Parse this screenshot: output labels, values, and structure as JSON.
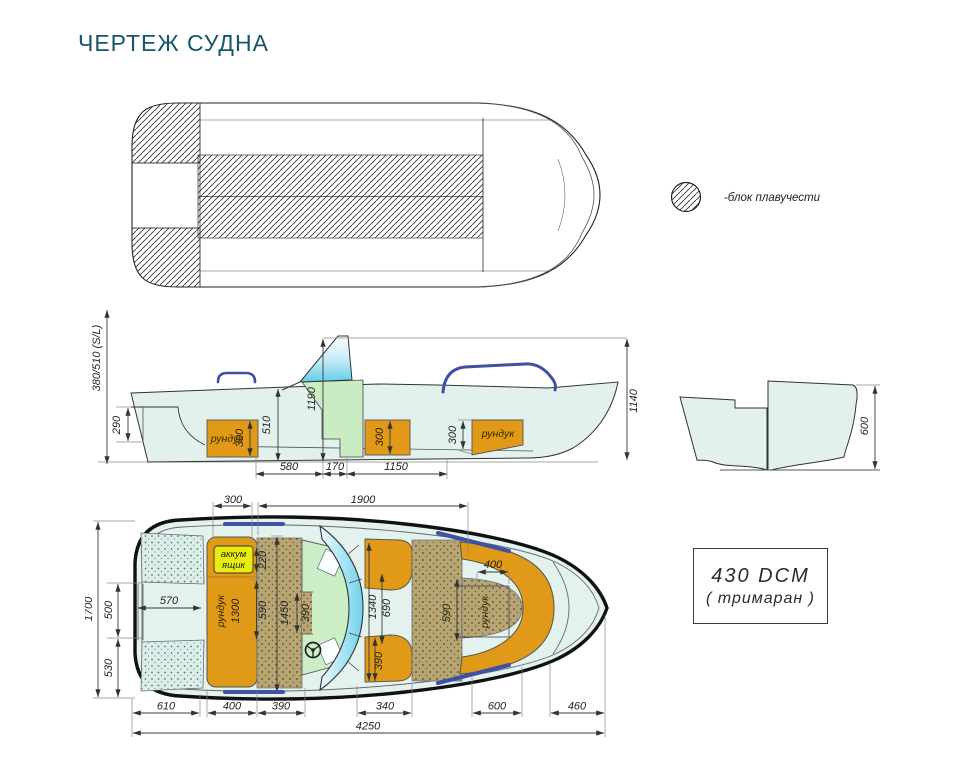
{
  "title": "ЧЕРТЕЖ СУДНА",
  "legend": {
    "label": "-блок плавучести"
  },
  "spec_box": {
    "model": "430 DCM",
    "type": "( тримаран )"
  },
  "colors": {
    "hull": "#e3f2ed",
    "seat_orange": "#e09a18",
    "battery_yellow": "#e8ec10",
    "floor_tan": "#b7a673",
    "console_green": "#cbeec6",
    "windshield_cyan": "#7fd8ee",
    "railing_blue": "#3f51a2",
    "title_teal": "#14566b"
  },
  "side_view": {
    "axis_label": "380/510 (S/L)",
    "locker_left": "рундук",
    "locker_right": "рундук",
    "d290": "290",
    "d510": "510",
    "d1190": "1190",
    "d1140": "1140",
    "d300_left": "300",
    "d300_mid": "300",
    "d300_right": "300",
    "d580": "580",
    "d170": "170",
    "d1150": "1150"
  },
  "transom_view": {
    "d600": "600"
  },
  "bottom_view": {
    "d1700": "1700",
    "d500": "500",
    "d530": "530",
    "d570": "570",
    "d300_top": "300",
    "d1900": "1900",
    "battery_line1": "аккум",
    "battery_line2": "ящик",
    "locker_main": "рундук",
    "d1300": "1300",
    "d220": "220",
    "d590_mid": "590",
    "d1450": "1450",
    "d390_console": "390",
    "d1340": "1340",
    "d690": "690",
    "d390_seat": "390",
    "d400_bow": "400",
    "d590_bow": "590",
    "locker_bow": "рундук",
    "d610": "610",
    "d400_bottom": "400",
    "d390_bottom": "390",
    "d340": "340",
    "d600_bottom": "600",
    "d460": "460",
    "d4250": "4250"
  }
}
